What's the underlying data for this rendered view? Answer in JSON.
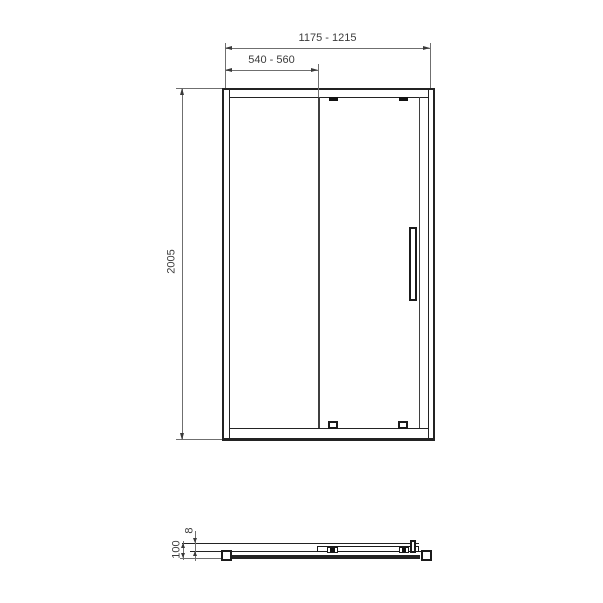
{
  "drawing": {
    "front_view": {
      "overall_width": "1175 - 1215",
      "door_width": "540 - 560",
      "height": "2005"
    },
    "profile_view": {
      "glass_thickness": "8",
      "profile_depth": "100"
    }
  }
}
